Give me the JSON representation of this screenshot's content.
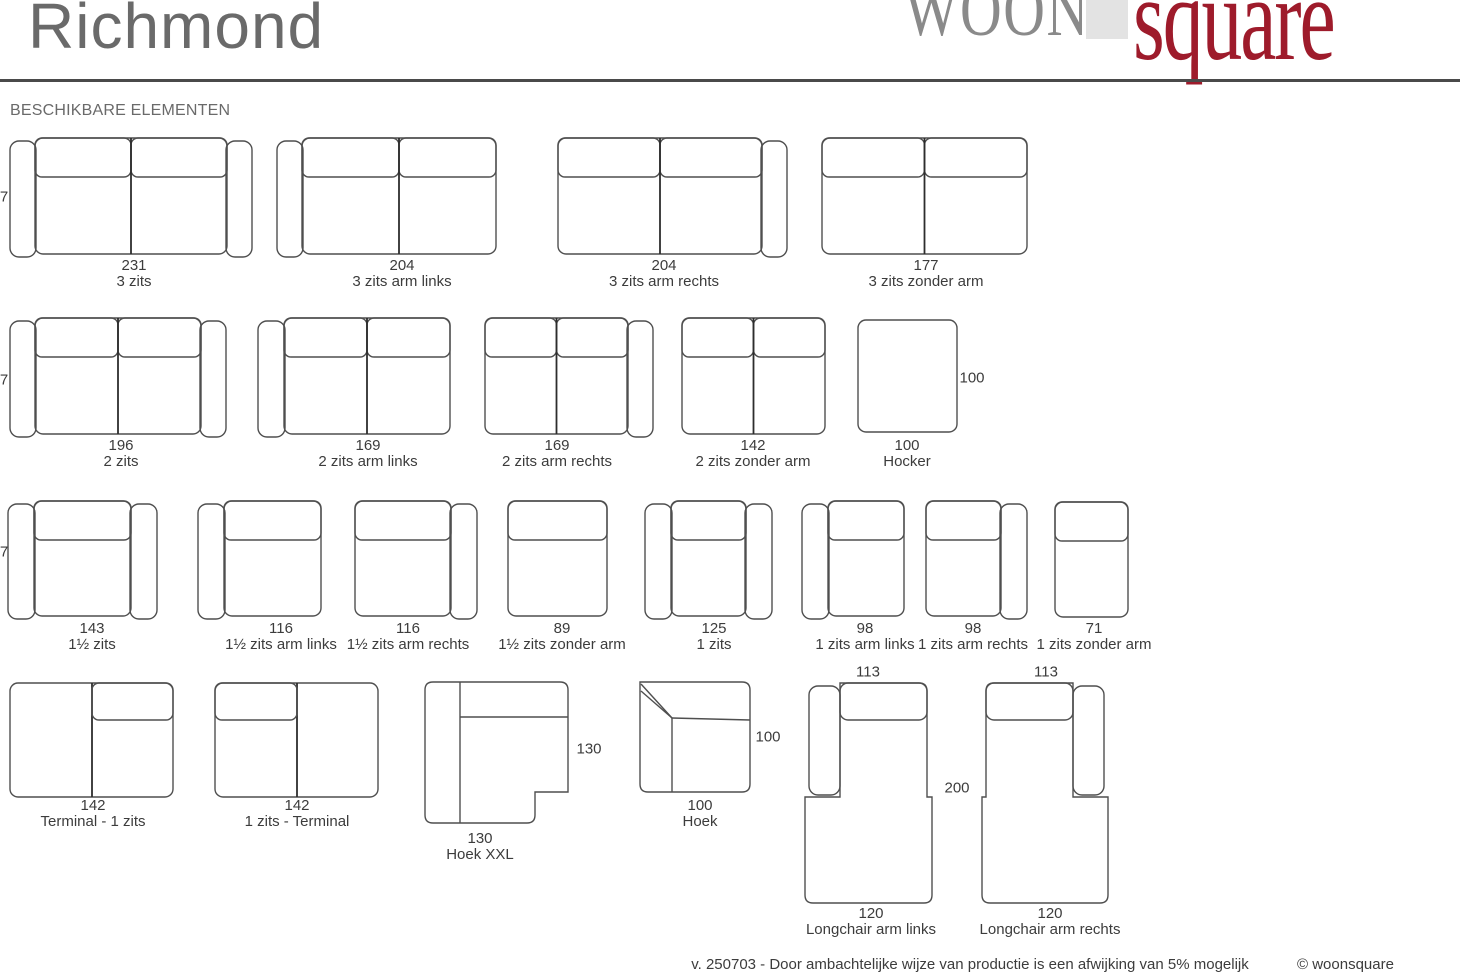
{
  "header": {
    "title": "Richmond",
    "logo": {
      "woon": "WOON",
      "square": "square"
    },
    "section_title": "BESCHIKBARE ELEMENTEN"
  },
  "colors": {
    "title": "#6a6a6a",
    "rule": "#4a4a4a",
    "outline": "#4f4f4f",
    "divider": "#2d2d2d",
    "text": "#3c3c3c",
    "logo-gray": "#8a8a8a",
    "logo-block": "#e3e3e3",
    "logo-red": "#9e1b2b"
  },
  "footer": {
    "note": "v. 250703 - Door ambachtelijke wijze van productie is een afwijking van 5% mogelijk",
    "copyright": "© woonsquare"
  },
  "diagram": {
    "elements": [
      {
        "name": "3-zits",
        "type": "sofa",
        "x": 10,
        "y": 138,
        "h": 116,
        "aw": 26,
        "bodyW": 192,
        "armL": true,
        "armR": true,
        "divider": true,
        "dim": "231",
        "label": "3 zits",
        "labelCx": 134,
        "labelY": 258
      },
      {
        "name": "3-zits-arm-links",
        "type": "sofa",
        "x": 277,
        "y": 138,
        "h": 116,
        "aw": 26,
        "bodyW": 194,
        "armL": true,
        "armR": false,
        "divider": true,
        "dim": "204",
        "label": "3 zits arm links",
        "labelCx": 402,
        "labelY": 258
      },
      {
        "name": "3-zits-arm-rechts",
        "type": "sofa",
        "x": 558,
        "y": 138,
        "h": 116,
        "aw": 26,
        "bodyW": 204,
        "armL": false,
        "armR": true,
        "divider": true,
        "dim": "204",
        "label": "3 zits arm rechts",
        "labelCx": 664,
        "labelY": 258
      },
      {
        "name": "3-zits-zonder-arm",
        "type": "sofa",
        "x": 822,
        "y": 138,
        "h": 116,
        "aw": 26,
        "bodyW": 205,
        "armL": false,
        "armR": false,
        "divider": true,
        "dim": "177",
        "label": "3 zits zonder arm",
        "labelCx": 926,
        "labelY": 258
      },
      {
        "name": "2-zits",
        "type": "sofa",
        "x": 10,
        "y": 318,
        "h": 116,
        "aw": 26,
        "bodyW": 166,
        "armL": true,
        "armR": true,
        "divider": true,
        "dim": "196",
        "label": "2 zits",
        "labelCx": 121,
        "labelY": 438
      },
      {
        "name": "2-zits-arm-links",
        "type": "sofa",
        "x": 258,
        "y": 318,
        "h": 116,
        "aw": 27,
        "bodyW": 166,
        "armL": true,
        "armR": false,
        "divider": true,
        "dim": "169",
        "label": "2 zits arm links",
        "labelCx": 368,
        "labelY": 438
      },
      {
        "name": "2-zits-arm-rechts",
        "type": "sofa",
        "x": 485,
        "y": 318,
        "h": 116,
        "aw": 26,
        "bodyW": 143,
        "armL": false,
        "armR": true,
        "divider": true,
        "dim": "169",
        "label": "2 zits arm rechts",
        "labelCx": 557,
        "labelY": 438
      },
      {
        "name": "2-zits-zonder-arm",
        "type": "sofa",
        "x": 682,
        "y": 318,
        "h": 116,
        "aw": 26,
        "bodyW": 143,
        "armL": false,
        "armR": false,
        "divider": true,
        "dim": "142",
        "label": "2 zits zonder arm",
        "labelCx": 753,
        "labelY": 438
      },
      {
        "name": "hocker",
        "type": "hocker",
        "x": 858,
        "y": 320,
        "w": 99,
        "h": 112,
        "dim": "100",
        "label": "Hocker",
        "labelCx": 907,
        "labelY": 438
      },
      {
        "name": "anderhalf-zits",
        "type": "sofa",
        "x": 8,
        "y": 501,
        "h": 115,
        "aw": 27,
        "bodyW": 97,
        "armL": true,
        "armR": true,
        "divider": false,
        "dim": "143",
        "label": "1½ zits",
        "labelCx": 92,
        "labelY": 621
      },
      {
        "name": "anderhalf-zits-arm-links",
        "type": "sofa",
        "x": 198,
        "y": 501,
        "h": 115,
        "aw": 27,
        "bodyW": 97,
        "armL": true,
        "armR": false,
        "divider": false,
        "dim": "116",
        "label": "1½ zits arm links",
        "labelCx": 281,
        "labelY": 621
      },
      {
        "name": "anderhalf-zits-arm-rechts",
        "type": "sofa",
        "x": 355,
        "y": 501,
        "h": 115,
        "aw": 27,
        "bodyW": 96,
        "armL": false,
        "armR": true,
        "divider": false,
        "dim": "116",
        "label": "1½ zits arm rechts",
        "labelCx": 408,
        "labelY": 621
      },
      {
        "name": "anderhalf-zits-zonder-arm",
        "type": "sofa",
        "x": 508,
        "y": 501,
        "h": 115,
        "aw": 27,
        "bodyW": 99,
        "armL": false,
        "armR": false,
        "divider": false,
        "dim": "89",
        "label": "1½ zits zonder arm",
        "labelCx": 562,
        "labelY": 621
      },
      {
        "name": "1-zits",
        "type": "sofa",
        "x": 645,
        "y": 501,
        "h": 115,
        "aw": 27,
        "bodyW": 75,
        "armL": true,
        "armR": true,
        "divider": false,
        "dim": "125",
        "label": "1 zits",
        "labelCx": 714,
        "labelY": 621
      },
      {
        "name": "1-zits-arm-links",
        "type": "sofa",
        "x": 802,
        "y": 501,
        "h": 115,
        "aw": 27,
        "bodyW": 76,
        "armL": true,
        "armR": false,
        "divider": false,
        "dim": "98",
        "label": "1 zits arm links",
        "labelCx": 865,
        "labelY": 621
      },
      {
        "name": "1-zits-arm-rechts",
        "type": "sofa",
        "x": 926,
        "y": 501,
        "h": 115,
        "aw": 27,
        "bodyW": 75,
        "armL": false,
        "armR": true,
        "divider": false,
        "dim": "98",
        "label": "1 zits arm rechts",
        "labelCx": 973,
        "labelY": 621
      },
      {
        "name": "1-zits-zonder-arm",
        "type": "sofa",
        "x": 1055,
        "y": 502,
        "h": 115,
        "aw": 27,
        "bodyW": 73,
        "armL": false,
        "armR": false,
        "divider": false,
        "dim": "71",
        "label": "1 zits zonder arm",
        "labelCx": 1094,
        "labelY": 621
      },
      {
        "name": "terminal-1-zits",
        "type": "terminal",
        "x": 10,
        "y": 683,
        "w": 163,
        "h": 114,
        "dividerX": 82,
        "cushionSide": "right",
        "dim": "142",
        "label": "Terminal - 1 zits",
        "labelCx": 93,
        "labelY": 798
      },
      {
        "name": "1-zits-terminal",
        "type": "terminal",
        "x": 215,
        "y": 683,
        "w": 163,
        "h": 114,
        "dividerX": 82,
        "cushionSide": "left",
        "dim": "142",
        "label": "1 zits - Terminal",
        "labelCx": 297,
        "labelY": 798
      },
      {
        "name": "hoek-xxl",
        "type": "hoekxxl",
        "x": 425,
        "y": 682,
        "w": 143,
        "h": 141,
        "notchX": 110,
        "notchY": 110,
        "dim": "130",
        "label": "Hoek XXL",
        "labelCx": 480,
        "labelY": 831
      },
      {
        "name": "hoek",
        "type": "hoek",
        "x": 640,
        "y": 682,
        "w": 110,
        "h": 110,
        "dim": "100",
        "label": "Hoek",
        "labelCx": 700,
        "labelY": 798
      },
      {
        "name": "longchair-arm-links",
        "type": "longchair",
        "x": 805,
        "y": 683,
        "side": "left",
        "dim": "120",
        "label": "Longchair arm links",
        "labelCx": 871,
        "labelY": 906
      },
      {
        "name": "longchair-arm-rechts",
        "type": "longchair",
        "x": 982,
        "y": 683,
        "side": "right",
        "dim": "120",
        "label": "Longchair arm rechts",
        "labelCx": 1050,
        "labelY": 906
      }
    ],
    "float_labels": [
      {
        "name": "depth-dim-row-1",
        "text": "7",
        "x": 4,
        "y": 197
      },
      {
        "name": "depth-dim-row-2",
        "text": "7",
        "x": 4,
        "y": 380
      },
      {
        "name": "depth-dim-row-3",
        "text": "7",
        "x": 4,
        "y": 552
      },
      {
        "name": "hocker-side-dim",
        "text": "100",
        "x": 972,
        "y": 378
      },
      {
        "name": "hoek-xxl-side-dim",
        "text": "130",
        "x": 589,
        "y": 749
      },
      {
        "name": "hoek-side-dim",
        "text": "100",
        "x": 768,
        "y": 737
      },
      {
        "name": "longchair-links-top-dim",
        "text": "113",
        "x": 868,
        "y": 672
      },
      {
        "name": "longchair-rechts-top-dim",
        "text": "113",
        "x": 1046,
        "y": 672
      },
      {
        "name": "longchair-length-dim",
        "text": "200",
        "x": 957,
        "y": 788
      }
    ]
  }
}
